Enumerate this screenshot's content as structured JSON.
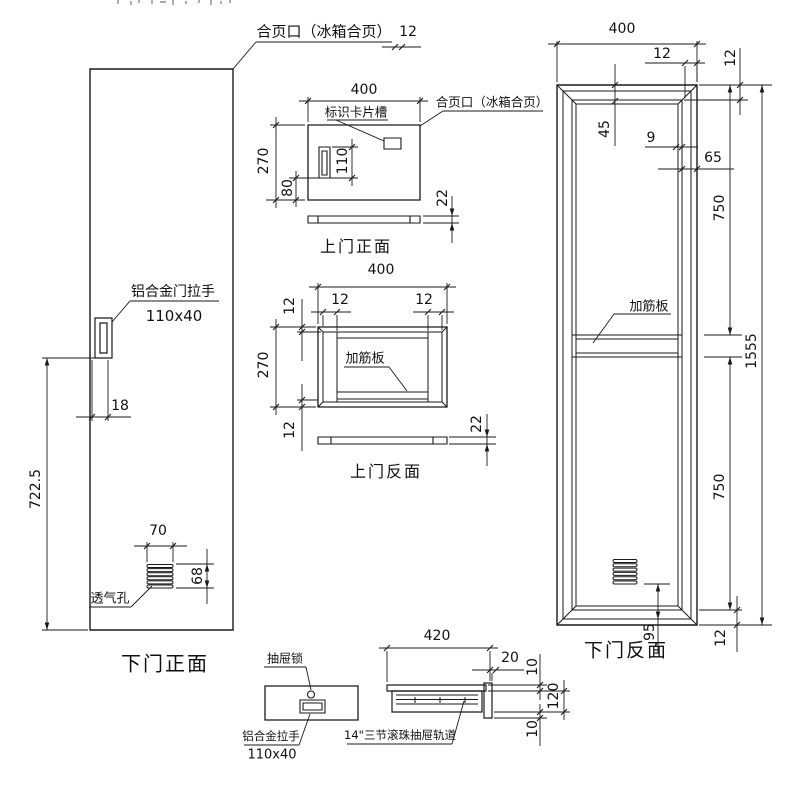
{
  "labels": {
    "hinge_top": "合页口（冰箱合页）",
    "hinge_mid": "合页口（冰箱合页）",
    "card_slot": "标识卡片槽",
    "door_handle": "铝合金门拉手",
    "door_handle_size": "110x40",
    "vent": "透气孔",
    "rib_upper": "加筋板",
    "rib_lower": "加筋板",
    "drawer_lock": "抽屉锁",
    "drawer_handle": "铝合金拉手",
    "drawer_handle_size": "110x40",
    "drawer_rail": "14\"三节滚珠抽屉轨道"
  },
  "captions": {
    "lower_door_front": "下门正面",
    "upper_door_front": "上门正面",
    "upper_door_back": "上门反面",
    "lower_door_back": "下门反面"
  },
  "dimensions": [
    {
      "id": "hinge-12",
      "value": "12",
      "x": 408,
      "y": 32,
      "rot": false
    },
    {
      "id": "door-18",
      "value": "18",
      "x": 120,
      "y": 406,
      "rot": false
    },
    {
      "id": "door-722-5",
      "value": "722.5",
      "x": 36,
      "y": 489,
      "rot": true
    },
    {
      "id": "vent-70",
      "value": "70",
      "x": 158,
      "y": 531,
      "rot": false
    },
    {
      "id": "vent-68",
      "value": "68",
      "x": 198,
      "y": 576,
      "rot": true
    },
    {
      "id": "uf-400",
      "value": "400",
      "x": 364,
      "y": 90,
      "rot": false
    },
    {
      "id": "uf-270",
      "value": "270",
      "x": 264,
      "y": 161,
      "rot": true
    },
    {
      "id": "uf-80",
      "value": "80",
      "x": 288,
      "y": 188,
      "rot": true
    },
    {
      "id": "uf-110",
      "value": "110",
      "x": 343,
      "y": 161,
      "rot": true
    },
    {
      "id": "uf-22",
      "value": "22",
      "x": 443,
      "y": 198,
      "rot": true
    },
    {
      "id": "ub-400",
      "value": "400",
      "x": 381,
      "y": 270,
      "rot": false
    },
    {
      "id": "ub-12-left",
      "value": "12",
      "x": 340,
      "y": 300,
      "rot": false
    },
    {
      "id": "ub-12-right",
      "value": "12",
      "x": 424,
      "y": 300,
      "rot": false
    },
    {
      "id": "ub-12-top",
      "value": "12",
      "x": 290,
      "y": 306,
      "rot": true
    },
    {
      "id": "ub-270",
      "value": "270",
      "x": 264,
      "y": 365,
      "rot": true
    },
    {
      "id": "ub-12-bottom",
      "value": "12",
      "x": 290,
      "y": 430,
      "rot": true
    },
    {
      "id": "ub-22",
      "value": "22",
      "x": 477,
      "y": 424,
      "rot": true
    },
    {
      "id": "rp-400",
      "value": "400",
      "x": 622,
      "y": 29,
      "rot": false
    },
    {
      "id": "rp-12-top",
      "value": "12",
      "x": 662,
      "y": 54,
      "rot": false
    },
    {
      "id": "rp-12-right",
      "value": "12",
      "x": 731,
      "y": 58,
      "rot": true
    },
    {
      "id": "rp-45",
      "value": "45",
      "x": 605,
      "y": 129,
      "rot": true
    },
    {
      "id": "rp-9",
      "value": "9",
      "x": 651,
      "y": 138,
      "rot": false
    },
    {
      "id": "rp-65",
      "value": "65",
      "x": 713,
      "y": 158,
      "rot": false
    },
    {
      "id": "rp-750-top",
      "value": "750",
      "x": 720,
      "y": 208,
      "rot": true
    },
    {
      "id": "rp-1555",
      "value": "1555",
      "x": 752,
      "y": 351,
      "rot": true
    },
    {
      "id": "rp-750-bottom",
      "value": "750",
      "x": 720,
      "y": 487,
      "rot": true
    },
    {
      "id": "rp-95",
      "value": "95",
      "x": 650,
      "y": 632,
      "rot": true
    },
    {
      "id": "rp-12-bottom",
      "value": "12",
      "x": 721,
      "y": 638,
      "rot": true
    },
    {
      "id": "rail-420",
      "value": "420",
      "x": 437,
      "y": 636,
      "rot": false
    },
    {
      "id": "rail-20",
      "value": "20",
      "x": 510,
      "y": 658,
      "rot": false
    },
    {
      "id": "rail-10-top",
      "value": "10",
      "x": 533,
      "y": 667,
      "rot": true
    },
    {
      "id": "rail-120",
      "value": "120",
      "x": 554,
      "y": 696,
      "rot": true
    },
    {
      "id": "rail-10-bottom",
      "value": "10",
      "x": 533,
      "y": 729,
      "rot": true
    }
  ],
  "colors": {
    "line": "#1a1a1a",
    "text": "#111111",
    "background": "#ffffff"
  }
}
